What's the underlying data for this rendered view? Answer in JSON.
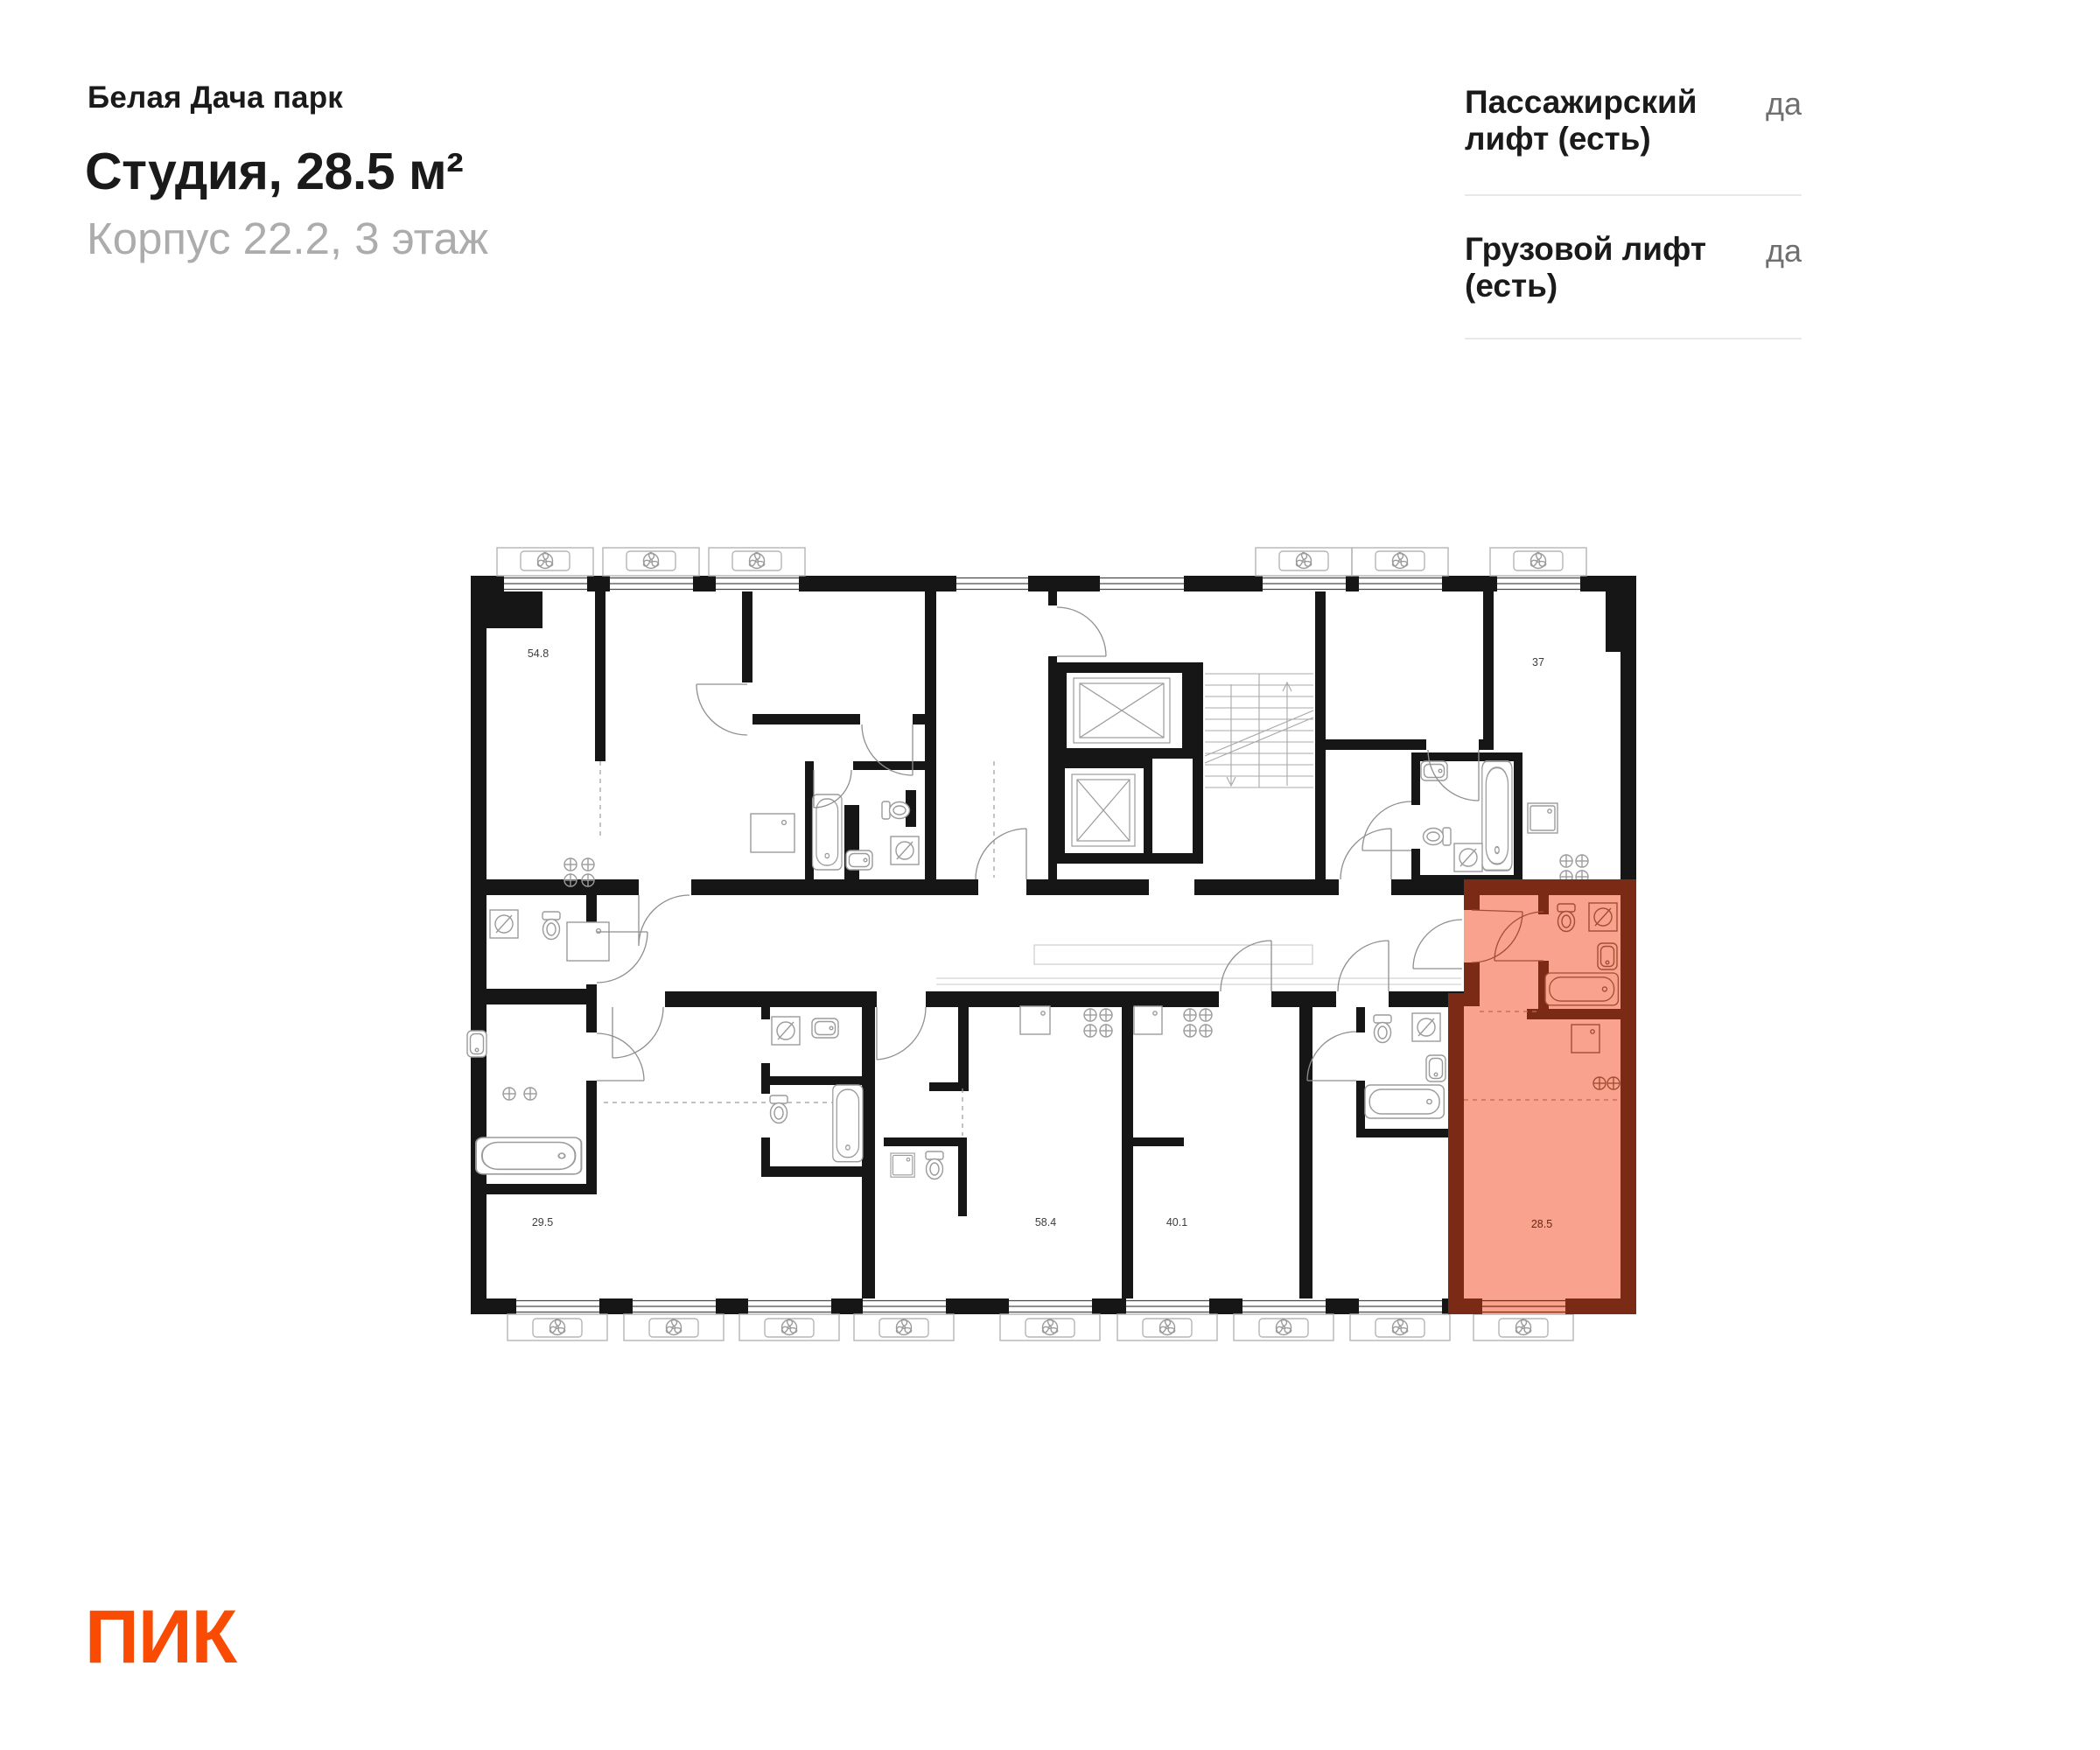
{
  "header": {
    "project": "Белая Дача парк",
    "title": "Студия, 28.5 м²",
    "subtitle": "Корпус 22.2, 3 этаж"
  },
  "info": {
    "rows": [
      {
        "label": "Пассажирский лифт (есть)",
        "value": "да"
      },
      {
        "label": "Грузовой лифт (есть)",
        "value": "да"
      }
    ]
  },
  "plan": {
    "units": [
      {
        "name": "unit-54-8",
        "area": "54.8",
        "highlighted": false
      },
      {
        "name": "unit-37",
        "area": "37",
        "highlighted": false
      },
      {
        "name": "unit-29-5",
        "area": "29.5",
        "highlighted": false
      },
      {
        "name": "unit-58-4",
        "area": "58.4",
        "highlighted": false
      },
      {
        "name": "unit-40-1",
        "area": "40.1",
        "highlighted": false
      },
      {
        "name": "unit-28-5",
        "area": "28.5",
        "highlighted": true
      }
    ],
    "colors": {
      "wall": "#161616",
      "highlight_fill": "#f9a38e",
      "highlight_wall": "#7b2a16",
      "fixture_line": "#9b9b9b",
      "highlight_fixture_line": "#a24e34",
      "label": "#3d3d3d",
      "highlight_label": "#6b2413"
    }
  },
  "logo": {
    "text": "ПИК",
    "color": "#fa4b05"
  }
}
